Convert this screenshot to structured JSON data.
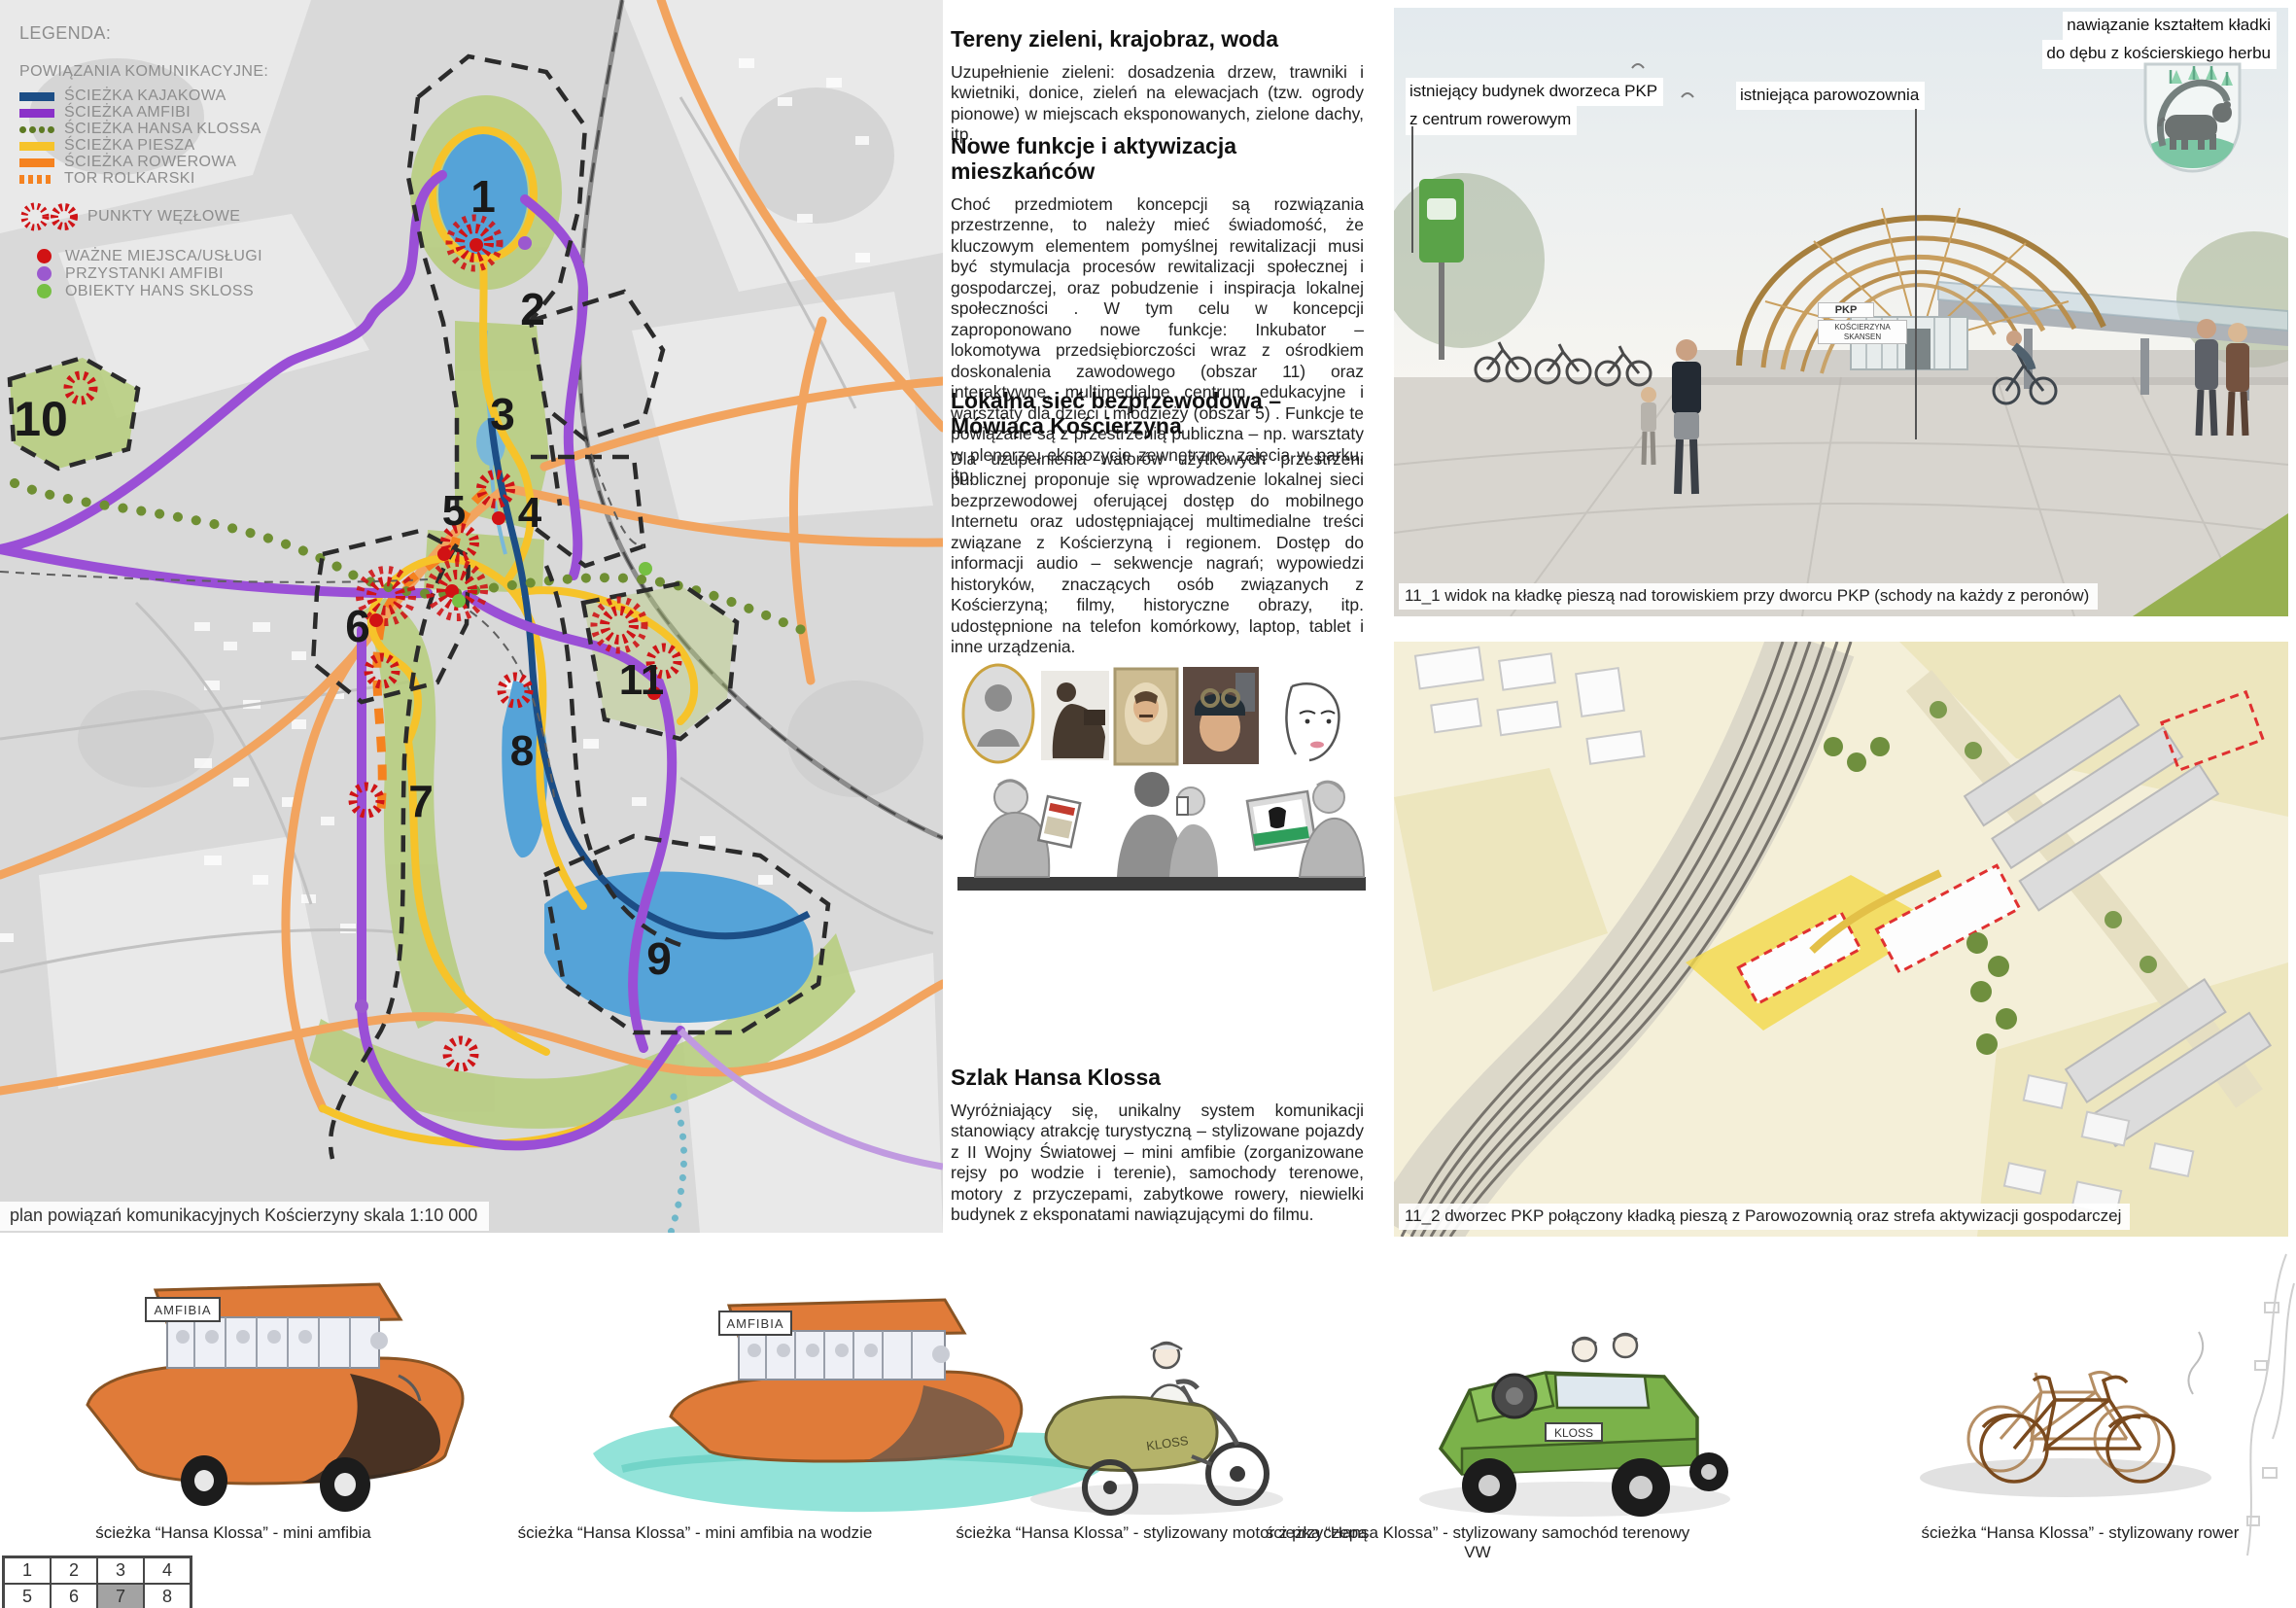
{
  "legend": {
    "title": "LEGENDA:",
    "connections_heading": "POWIĄZANIA KOMUNIKACYJNE:",
    "routes": [
      {
        "label": "ŚCIEŻKA KAJAKOWA",
        "color": "#1c4e86",
        "style": "solid"
      },
      {
        "label": "ŚCIEŻKA AMFIBI",
        "color": "#8a31c9",
        "style": "solid"
      },
      {
        "label": "ŚCIEŻKA HANSA KLOSSA",
        "color": "#5d7a23",
        "style": "dotted"
      },
      {
        "label": "ŚCIEŻKA PIESZA",
        "color": "#f6c32a",
        "style": "solid"
      },
      {
        "label": "ŚCIEŻKA ROWEROWA",
        "color": "#f58220",
        "style": "solid"
      },
      {
        "label": "TOR ROLKARSKI",
        "color": "#f58220",
        "style": "dashed"
      }
    ],
    "nodes_label": "PUNKTY WĘZŁOWE",
    "nodes_color": "#cf1417",
    "points": [
      {
        "label": "WAŻNE MIEJSCA/USŁUGI",
        "color": "#d11214"
      },
      {
        "label": "PRZYSTANKI AMFIBI",
        "color": "#9b59cf"
      },
      {
        "label": "OBIEKTY HANS SKLOSS",
        "color": "#76c043"
      }
    ]
  },
  "map": {
    "caption": "plan powiązań komunikacyjnych Kościerzyny skala 1:10 000",
    "areas": [
      "1",
      "2",
      "3",
      "4",
      "5",
      "6",
      "7",
      "8",
      "9",
      "10",
      "11"
    ],
    "colors": {
      "water": "#55a3d8",
      "greenery": "#b5cc7a",
      "node": "#cf1417",
      "boundary": "#2b2b2b"
    }
  },
  "articles": {
    "greenery": {
      "title": "Tereny zieleni, krajobraz, woda",
      "body": "Uzupełnienie zieleni: dosadzenia drzew, trawniki i kwietniki, donice, zieleń na elewacjach (tzw. ogrody pionowe) w miejscach eksponowanych, zielone dachy, itp."
    },
    "functions": {
      "title": "Nowe funkcje i aktywizacja mieszkańców",
      "body": "Choć przedmiotem koncepcji są rozwiązania przestrzenne, to należy mieć świadomość, że kluczowym elementem pomyślnej rewitalizacji musi być stymulacja procesów rewitalizacji społecznej i gospodarczej, oraz pobudzenie i inspiracja lokalnej społeczności . W tym celu w koncepcji zaproponowano nowe funkcje: Inkubator – lokomotywa przedsiębiorczości wraz z ośrodkiem doskonalenia zawodowego (obszar 11) oraz interaktywne, multimedialne centrum edukacyjne i warsztaty dla dzieci i młodzieży (obszar 5) . Funkcje te powiązane są z przestrzenią publiczna – np. warsztaty w plenerze, ekspozycje zewnętrzne, zajęcia w parku, itp."
    },
    "wireless": {
      "title": "Lokalna sieć bezprzewodowa – Mówiąca Kościerzyna",
      "body": "Dla uzupełnienia walorów użytkowych przestrzeni publicznej proponuje się wprowadzenie lokalnej sieci bezprzewodowej oferującej dostęp do mobilnego Internetu oraz udostępniającej multimedialne treści związane z Kościerzyną i regionem. Dostęp do informacji audio – sekwencje nagrań; wypowiedzi historyków, znaczących osób związanych z Kościerzyną; filmy, historyczne obrazy, itp. udostępnione na telefon komórkowy, laptop, tablet i inne urządzenia."
    },
    "szlak": {
      "title": "Szlak Hansa Klossa",
      "body": "Wyróżniający się, unikalny system komunikacji stanowiący atrakcję turystyczną – stylizowane pojazdy z II Wojny Światowej – mini amfibie (zorganizowane rejsy po wodzie i terenie), samochody terenowe, motory z przyczepami, zabytkowe rowery, niewielki budynek z eksponatami nawiązującymi do filmu."
    }
  },
  "render_top": {
    "annotation_bridge_line1": "nawiązanie kształtem kładki",
    "annotation_bridge_line2": "do dębu z kościerskiego herbu",
    "label_station_line1": "istniejący budynek dworzeca PKP",
    "label_station_line2": "z centrum rowerowym",
    "label_roundhouse": "istniejąca parowozownia",
    "sign_pkp": "PKP",
    "sign_koscierzyna": "KOŚCIERZYNA SKANSEN",
    "caption": "11_1  widok na kładkę pieszą nad torowiskiem przy dworcu PKP (schody na każdy z peronów)"
  },
  "render_bottom": {
    "caption": "11_2 dworzec PKP połączony kładką pieszą z Parowozownią oraz strefa aktywizacji gospodarczej"
  },
  "vehicles": [
    {
      "caption": "ścieżka “Hansa Klossa” - mini amfibia",
      "sign": "AMFIBIA"
    },
    {
      "caption": "ścieżka “Hansa Klossa” - mini amfibia na wodzie",
      "sign": "AMFIBIA"
    },
    {
      "caption": "ścieżka “Hansa Klossa” - stylizowany motor z przyczepą",
      "sign": "KLOSS"
    },
    {
      "caption": "ścieżka “Hansa Klossa” - stylizowany samochód terenowy VW",
      "sign": "KLOSS"
    },
    {
      "caption": "ścieżka “Hansa Klossa” - stylizowany rower"
    }
  ],
  "page_index": {
    "cells": [
      "1",
      "2",
      "3",
      "4",
      "5",
      "6",
      "7",
      "8"
    ],
    "active": "7"
  }
}
